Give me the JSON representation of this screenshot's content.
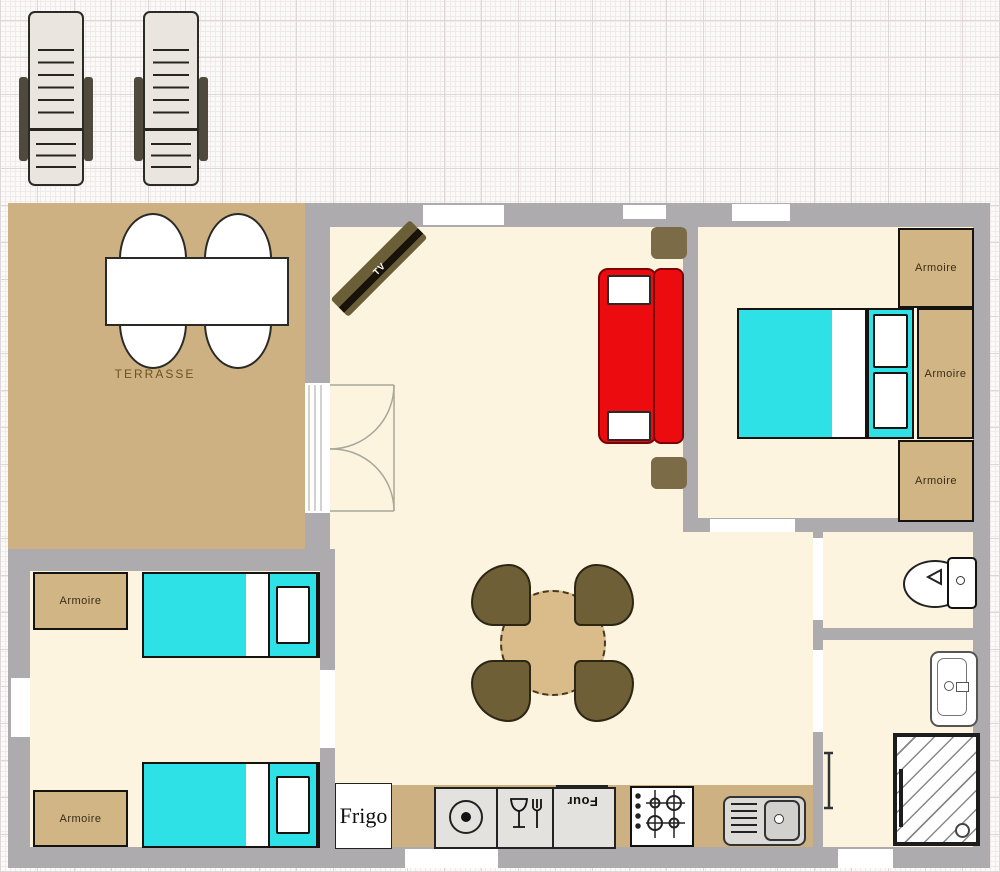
{
  "labels": {
    "terrace": "TERRASSE",
    "armoire": "Armoire",
    "tv": "TV",
    "fridge": "Frigo",
    "oven": "Four"
  },
  "colors": {
    "wall": "#aeabae",
    "floor": "#fcf4de",
    "terrace_floor": "#cdb183",
    "kitchen_counter": "#cdb183",
    "armoire": "#d2b585",
    "bed": "#2ee1e6",
    "sofa": "#ec0c10",
    "dining_table": "#d9bc8a",
    "dining_chair": "#6e5f37",
    "tv_unit": "#6b5f38",
    "side_table": "#7b6b46"
  },
  "icons": {
    "hotplate": "hotplate-icon",
    "dishwasher": "glass-fork-icon",
    "stove": "gas-stove-icon",
    "sink": "sink-icon",
    "toilet": "toilet-icon",
    "washbasin": "washbasin-icon",
    "shower": "shower-icon",
    "door_swing": "door-swing-icon"
  }
}
